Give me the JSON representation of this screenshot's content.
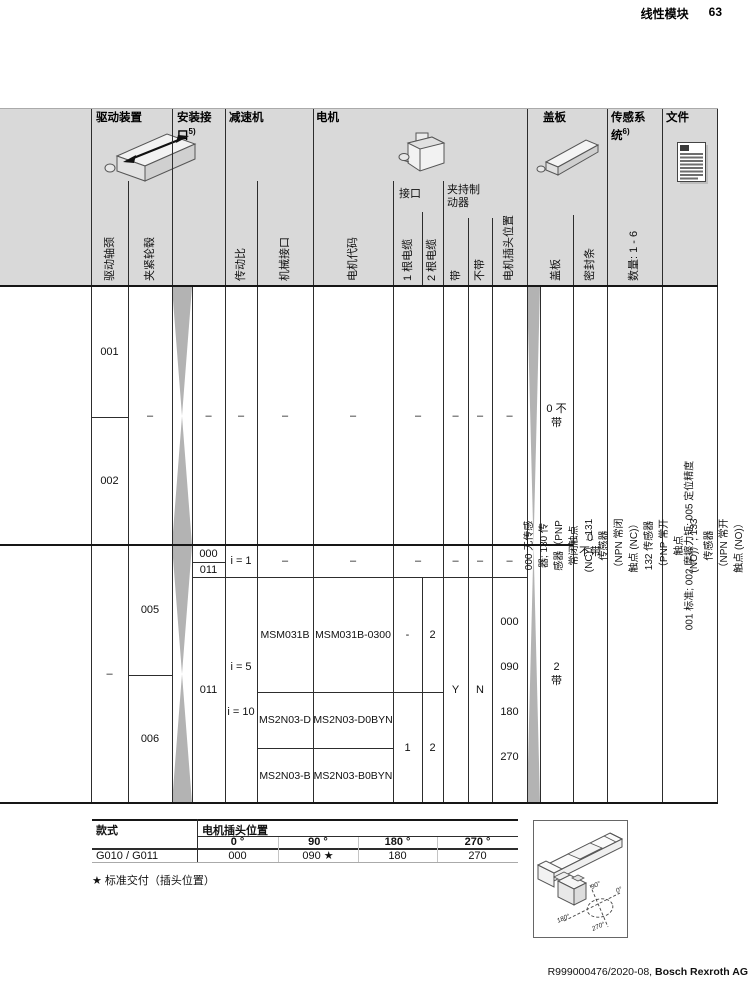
{
  "page": {
    "title": "线性模块",
    "number": "63",
    "footer_ref": "R999000476/2020-08, ",
    "footer_company": "Bosch Rexroth AG"
  },
  "header": {
    "groups": {
      "drive": "驱动装置",
      "mount": "安装接口",
      "mount_sup": "5)",
      "gear": "减速机",
      "motor": "电机",
      "cover": "盖板",
      "sensor": "传感系统",
      "sensor_sup": "6)",
      "file": "文件"
    },
    "sub": {
      "journal": "驱动轴颈",
      "hub": "夹紧轮毂",
      "ratio": "传动比",
      "mech": "机械接口",
      "motor_code": "电机代码",
      "interface": "接口",
      "cable1": "1 根电缆",
      "cable2": "2 根电缆",
      "brake": "夹持制动器",
      "with": "带",
      "without": "不带",
      "plug_pos": "电机插头位置",
      "cover": "盖板",
      "seal": "密封条",
      "qty": "数量: 1 - 6"
    }
  },
  "body": {
    "b1": {
      "journal_top": "001",
      "journal_bottom": "002",
      "hub": "–",
      "mount": "–",
      "ratio": "–",
      "mech": "–",
      "code": "–",
      "iface": "–",
      "with": "–",
      "without": "–",
      "plug": "–",
      "cover": [
        "0 不",
        "带"
      ]
    },
    "b2": {
      "journal": "–",
      "hub_top": "005",
      "hub_bottom": "006",
      "mount_000": "000",
      "mount_011a": "011",
      "mount_011b": "011",
      "ratio_i1": "i = 1",
      "ratio_rest": [
        "i = 5",
        "i = 10"
      ],
      "i1_mech": "–",
      "i1_code": "–",
      "i1_iface": "–",
      "i1_with": "–",
      "i1_without": "–",
      "i1_plug": "–",
      "msm_mech": "MSM031B",
      "msm_code": "MSM031B-0300",
      "msm_c1": "-",
      "msm_c2": "2",
      "d_mech": "MS2N03-D",
      "d_code": "MS2N03-D0BYN",
      "b_mech": "MS2N03-B",
      "b_code": "MS2N03-B0BYN",
      "ms2n_c1": "1",
      "ms2n_c2": "2",
      "with": "Y",
      "without": "N",
      "plug": [
        "000",
        "090",
        "180",
        "270"
      ],
      "cover": [
        "2",
        "带"
      ]
    },
    "seal": [
      "0",
      "不带"
    ],
    "sensor_lines": [
      "000 无传感器; 130 传感器（PNP 常闭触点 (NC)）; 131 传感器（NPN 常闭触点 (NC)）",
      "132 传感器（PNP 常开触点 (NO)）; 133 传感器（NPN 常开触点 (NO)）"
    ],
    "file_text": "001 标准; 002 摩擦力矩; 005 定位精度"
  },
  "bottom_table": {
    "style_header": "款式",
    "plug_header": "电机插头位置",
    "deg_headers": [
      "0 °",
      "90 °",
      "180 °",
      "270 °"
    ],
    "row_label": "G010 / G011",
    "row_values": [
      "000",
      "090 ★",
      "180",
      "270"
    ]
  },
  "note": "★ 标准交付（插头位置）",
  "illustration": {
    "deg0": "0°",
    "deg90": "90°",
    "deg180": "180°",
    "deg270": "270°"
  }
}
